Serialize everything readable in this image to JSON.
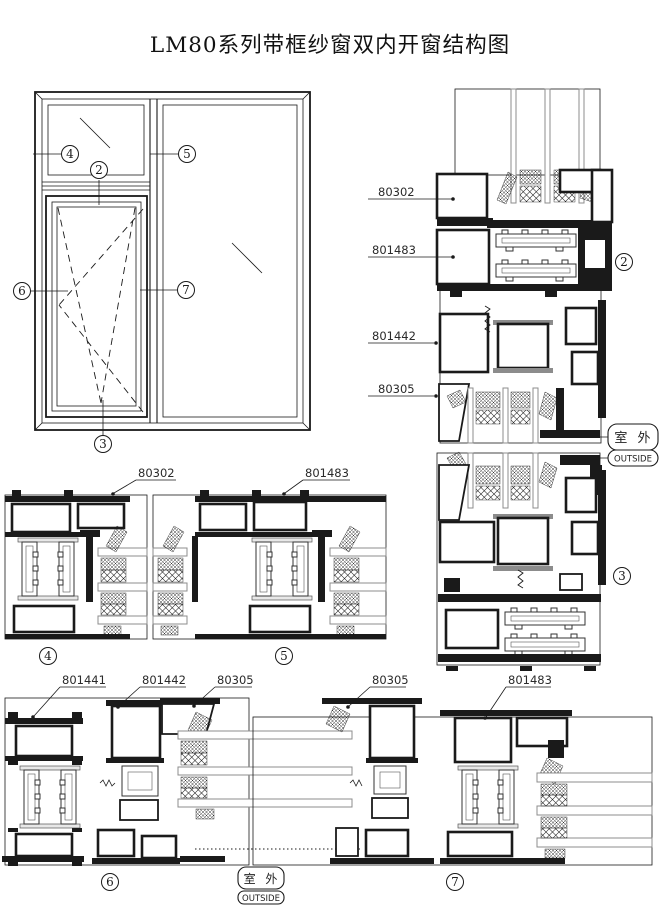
{
  "title": "LM80系列带框纱窗双内开窗结构图",
  "outside_stamp": {
    "cn": "室 外",
    "en": "OUTSIDE"
  },
  "balloons": {
    "n2": "2",
    "n3": "3",
    "n4": "4",
    "n5": "5",
    "n6": "6",
    "n7": "7"
  },
  "part_labels": {
    "sec2": {
      "a": "80302",
      "b": "801483",
      "c": "801442",
      "d": "80305"
    },
    "mid": {
      "a": "80302",
      "b": "801483"
    },
    "bottom": {
      "a": "801441",
      "b": "801442",
      "c": "80305",
      "d": "80305",
      "e": "801483"
    }
  },
  "colors": {
    "line": "#1a1a1a",
    "glass_edge": "#8c8c8c",
    "background": "#ffffff"
  }
}
